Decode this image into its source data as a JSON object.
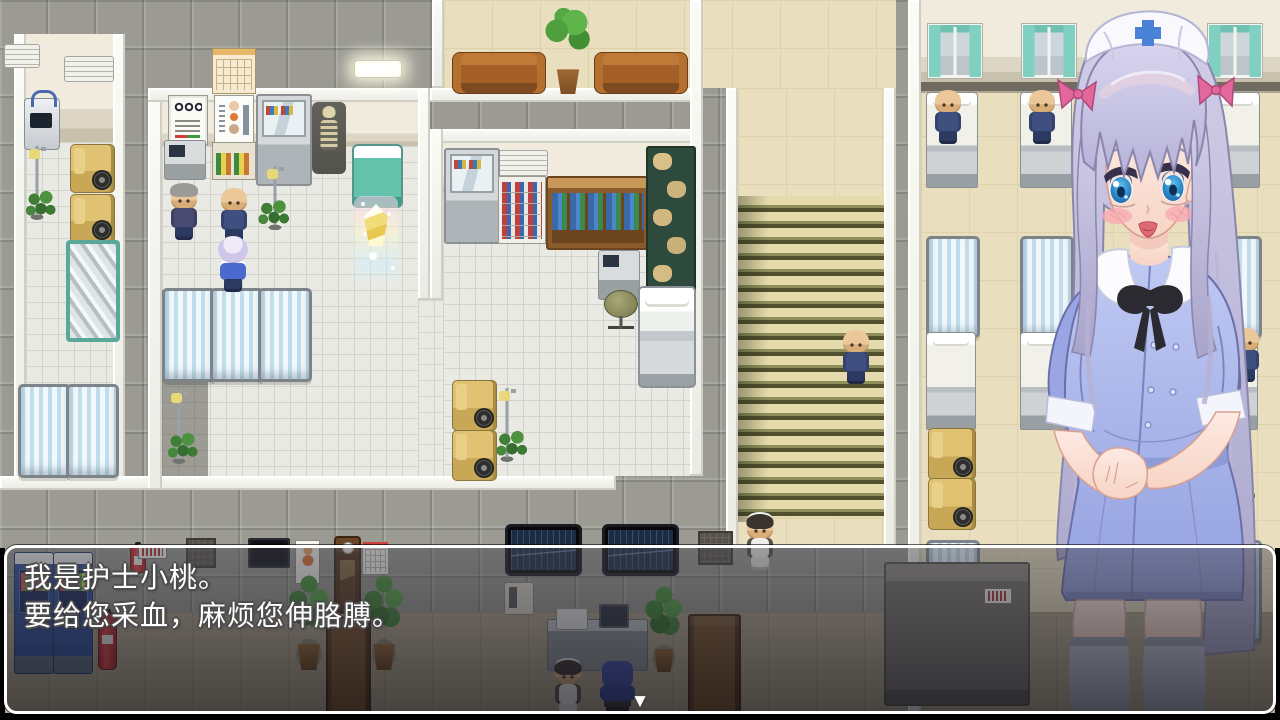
{
  "dialog": {
    "lines": [
      "我是护士小桃。",
      "要给您采血，麻烦您伸胳膊。"
    ],
    "continue_indicator": "▼"
  },
  "colors": {
    "dialog_border": "#ffffff",
    "dialog_background": "rgba(16,16,24,0.6)",
    "dialog_text": "#ffffff",
    "nurse_dress": "#a9b5e9",
    "nurse_hair": "#c3bfdc",
    "hair_ribbon": "#e2679c",
    "corridor_floor": "#e9dfbe",
    "stair_stripe": "#50502e",
    "curtain_teal": "#7fd0c0",
    "wheelchair_yellow": "#e0c272",
    "vending_blue": "#2c4c9c"
  },
  "scene": {
    "location": "hospital-interior",
    "objects": [
      "hospital-bed",
      "privacy-screen",
      "wheelchair",
      "iv-stand",
      "potted-plant",
      "vending-machine",
      "fire-extinguisher",
      "skeleton-model",
      "save-crystal",
      "exam-bed",
      "eye-chart",
      "anatomy-poster",
      "medicine-cabinet",
      "calendar",
      "couch",
      "potted-tree",
      "stairs",
      "window-curtains",
      "wall-monitor",
      "wall-phone",
      "office-desk",
      "office-chair",
      "wooden-door",
      "grandfather-clock",
      "mirror",
      "storage-rack",
      "patients",
      "maids",
      "nurse-portrait"
    ]
  }
}
